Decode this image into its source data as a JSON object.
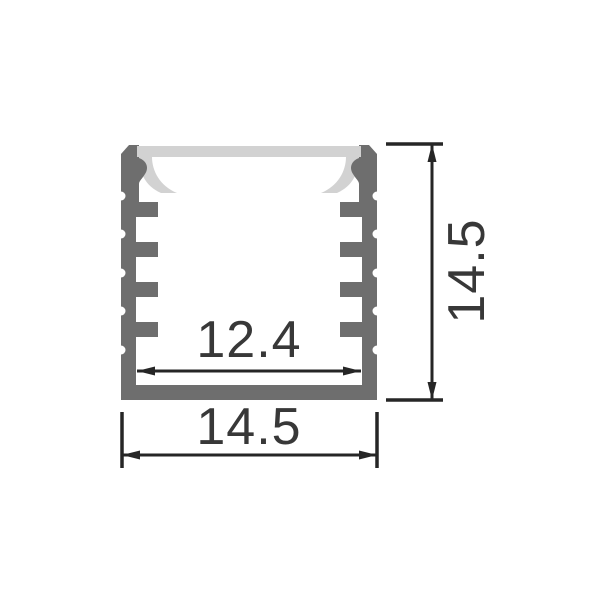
{
  "drawing": {
    "labels": {
      "inner_width": "12.4",
      "outer_width": "14.5",
      "height": "14.5"
    },
    "colors": {
      "aluminum": "#6e6e6e",
      "diffuser": "#d2d2d2",
      "line": "#262626",
      "text": "#383838",
      "background": "#ffffff"
    }
  }
}
